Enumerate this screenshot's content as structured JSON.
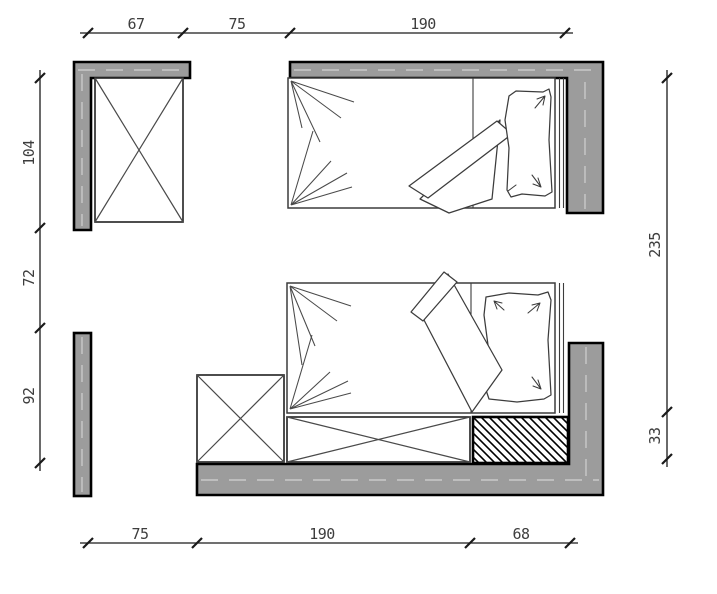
{
  "drawing_kind": "floor-plan",
  "dimensions": {
    "top": {
      "labels": [
        "67",
        "75",
        "190"
      ],
      "values": [
        67,
        75,
        190
      ]
    },
    "left": {
      "labels": [
        "104",
        "72",
        "92"
      ],
      "values": [
        104,
        72,
        92
      ]
    },
    "right": {
      "labels": [
        "235",
        "33"
      ],
      "values": [
        235,
        33
      ]
    },
    "bottom": {
      "labels": [
        "75",
        "190",
        "68"
      ],
      "values": [
        75,
        190,
        68
      ]
    }
  },
  "elements": {
    "walls": [
      "wall-top-left",
      "wall-top-right",
      "wall-left",
      "wall-bottom-right"
    ],
    "furniture": [
      "wardrobe-top-left",
      "bed-top",
      "bed-bottom",
      "wardrobe-bottom",
      "chest-bottom",
      "hatched-block"
    ]
  },
  "colors": {
    "background": "#ffffff",
    "wall_fill": "#9c9c9c",
    "outline": "#000000",
    "furniture_stroke": "#4a4a4a",
    "dimension_text": "#3d3d3d"
  }
}
